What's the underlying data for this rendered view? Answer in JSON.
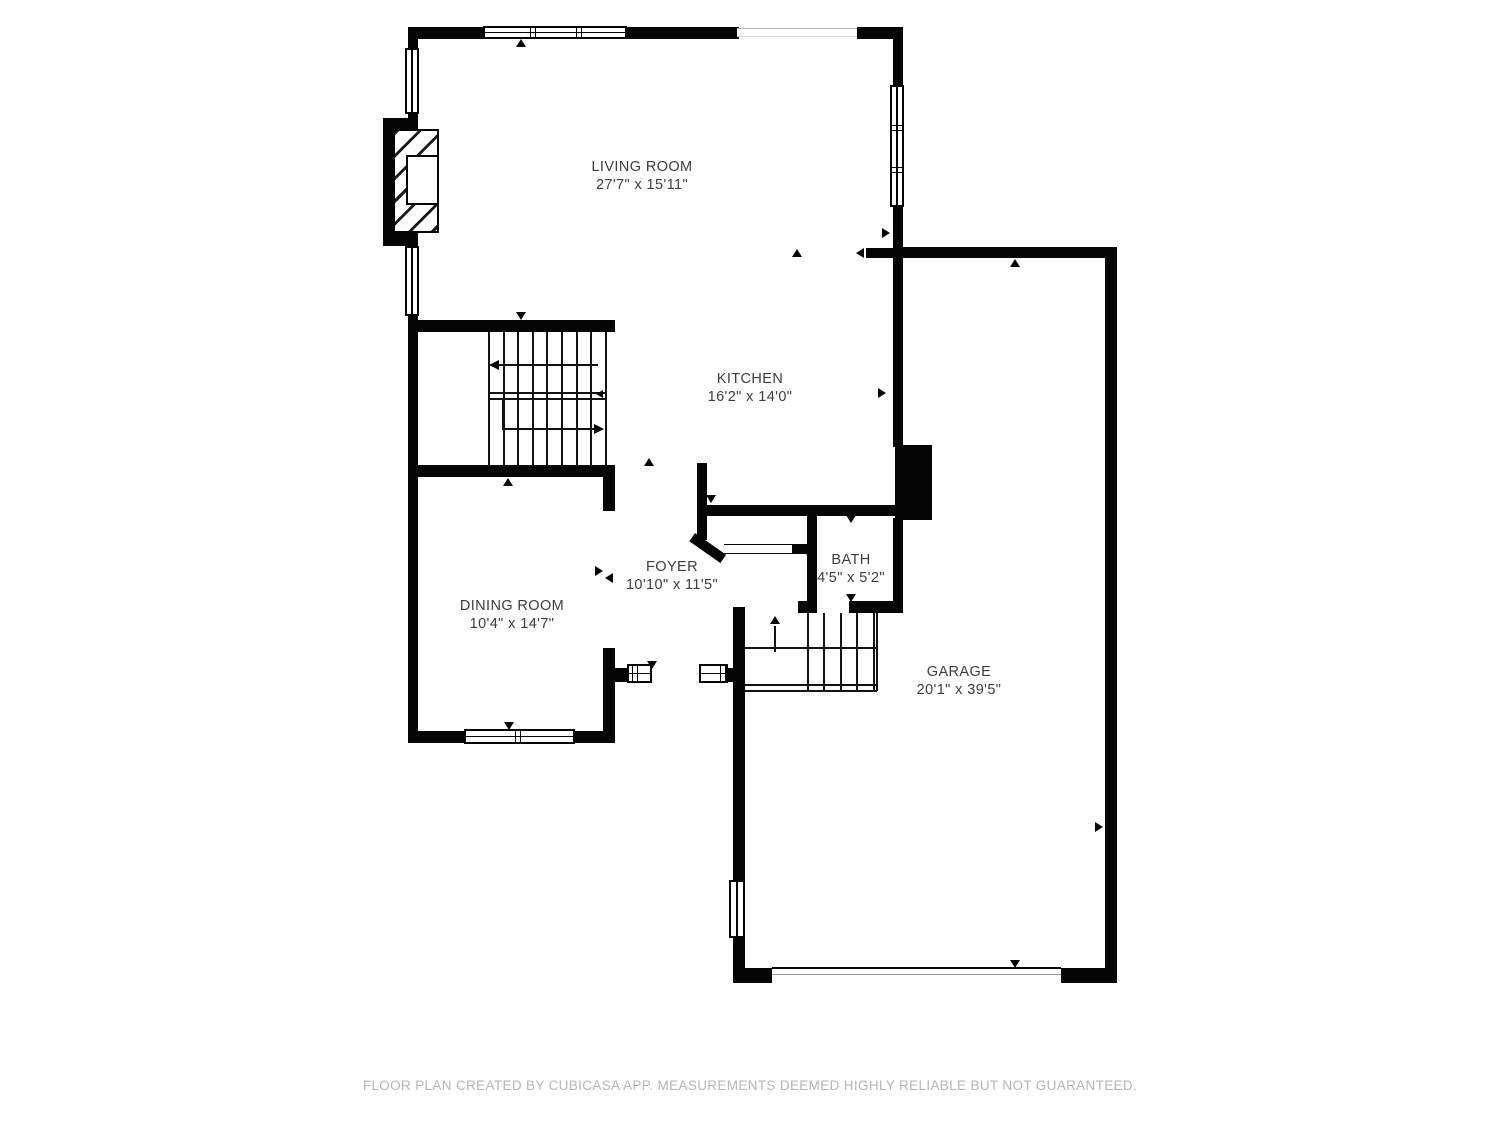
{
  "rooms": [
    {
      "name": "LIVING ROOM",
      "dims": "27'7\" x 15'11\""
    },
    {
      "name": "KITCHEN",
      "dims": "16'2\" x 14'0\""
    },
    {
      "name": "DINING ROOM",
      "dims": "10'4\" x 14'7\""
    },
    {
      "name": "FOYER",
      "dims": "10'10\" x 11'5\""
    },
    {
      "name": "BATH",
      "dims": "4'5\" x 5'2\""
    },
    {
      "name": "GARAGE",
      "dims": "20'1\" x 39'5\""
    }
  ],
  "footer": {
    "disclaimer": "FLOOR PLAN CREATED BY CUBICASA APP. MEASUREMENTS DEEMED HIGHLY RELIABLE BUT NOT GUARANTEED."
  },
  "colors": {
    "wall": "#050505",
    "room_text": "#3d3d3d",
    "footer_text": "#b5b5b5",
    "background": "#ffffff"
  }
}
